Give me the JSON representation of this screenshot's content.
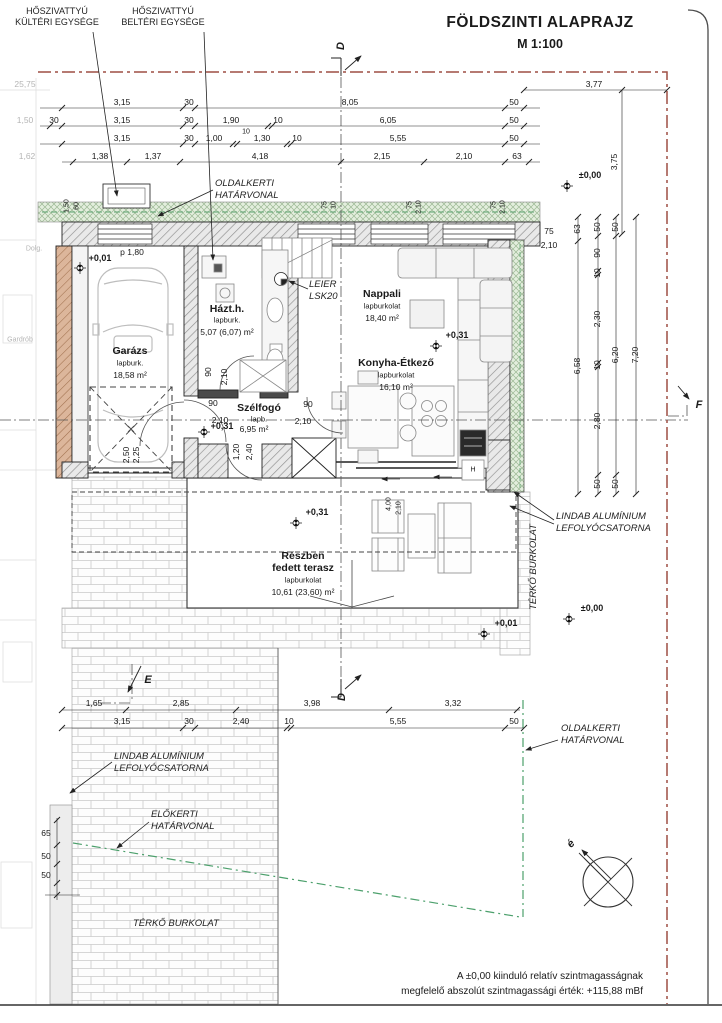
{
  "title": {
    "main": "FÖLDSZINTI ALAPRAJZ",
    "scale": "M 1:100"
  },
  "colors": {
    "boundary_red": "#9e4f44",
    "boundary_green": "#4ca06c",
    "wall_hatch_grey": "#909090",
    "brown_wall": "#a1714f",
    "green_band": "#e3eedd"
  },
  "callouts": {
    "heatpump_outdoor": "HŐSZIVATTYÚ\nKÜLTÉRI EGYSÉGE",
    "heatpump_indoor": "HŐSZIVATTYÚ\nBELTÉRI EGYSÉGE",
    "side_boundary_top": "OLDALKERTI\nHATÁRVONAL",
    "side_boundary_right": "OLDALKERTI\nHATÁRVONAL",
    "front_boundary": "ELŐKERTI\nHATÁRVONAL",
    "gutter_right": "LINDAB ALUMÍNIUM\nLEFOLYÓCSATORNA",
    "gutter_left": "LINDAB ALUMÍNIUM\nLEFOLYÓCSATORNA",
    "leier": "LEIER\nLSK20",
    "paving_east": "TÉRKŐ BURKOLAT",
    "paving_bottom": "TÉRKŐ BURKOLAT",
    "note": "A ±0,00 kiinduló relatív szintmagasságnak\nmegfelelő abszolút szintmagassági érték: +115,88 mBf"
  },
  "rooms": {
    "garazs": {
      "name": "Garázs",
      "finish": "lapburk.",
      "area": "18,58 m²"
    },
    "hazth": {
      "name": "Házt.h.",
      "finish": "lapburk.",
      "area": "5,07 (6,07) m²"
    },
    "nappali": {
      "name": "Nappali",
      "finish": "lapburkolat",
      "area": "18,40 m²"
    },
    "konyha": {
      "name": "Konyha-Étkező",
      "finish": "lapburkolat",
      "area": "16,10 m²"
    },
    "szelfogo": {
      "name": "Szélfogó",
      "finish": "lapb.",
      "area": "6,95 m²"
    },
    "terasz": {
      "name": "Részben\nfedett terasz",
      "finish": "lapburkolat",
      "area": "10,61 (23,60) m²"
    }
  },
  "levels": {
    "garage": "+0,01",
    "garage_p": "p 1,80",
    "nappali": "+0,31",
    "szelfogo": "+0,31",
    "terasz": "+0,31",
    "ne_corner": "±0,00",
    "se_corner": "±0,00",
    "terrace_front": "+0,01"
  },
  "sections": {
    "d_top": "D",
    "d_bottom": "D",
    "e": "E",
    "f": "F",
    "north": "é"
  },
  "appliance_h": "H",
  "dims": {
    "t0_left": "25,75",
    "t0": "3,77",
    "t1": [
      "3,15",
      "30",
      "8,05",
      "50"
    ],
    "t2": [
      "30",
      "3,15",
      "30",
      "1,90",
      "10",
      "10",
      "6,05",
      "50"
    ],
    "t3": [
      "3,15",
      "30",
      "1,00",
      "1,30",
      "10",
      "5,55",
      "50"
    ],
    "t4": [
      "1,38",
      "1,37",
      "4,18",
      "2,15",
      "2,10",
      "63"
    ],
    "v375": "3,75",
    "win": [
      "1,50",
      "60",
      "75",
      "10",
      "75",
      "2,10",
      "75",
      "2,10",
      "75",
      "2,10"
    ],
    "rc_a": [
      "63",
      "6,58"
    ],
    "rc_b": [
      "50",
      "90",
      "10",
      "2,30",
      "10",
      "2,80",
      "50"
    ],
    "rc_c": [
      "50",
      "6,20",
      "50"
    ],
    "rc_d": [
      "7,20"
    ],
    "door": [
      "90",
      "2,10",
      "90",
      "2,10",
      "1,20",
      "2,40",
      "2,50",
      "2,25",
      "90",
      "2,10",
      "4,00",
      "2,10"
    ],
    "b1": [
      "1,65",
      "2,85",
      "3,98",
      "3,32"
    ],
    "b2": [
      "3,15",
      "30",
      "2,40",
      "10",
      "5,55",
      "50"
    ],
    "lvert": [
      "65",
      "50",
      "50"
    ],
    "faint": [
      "1,50",
      "1,62",
      "Gardrób",
      "Dolg."
    ]
  }
}
